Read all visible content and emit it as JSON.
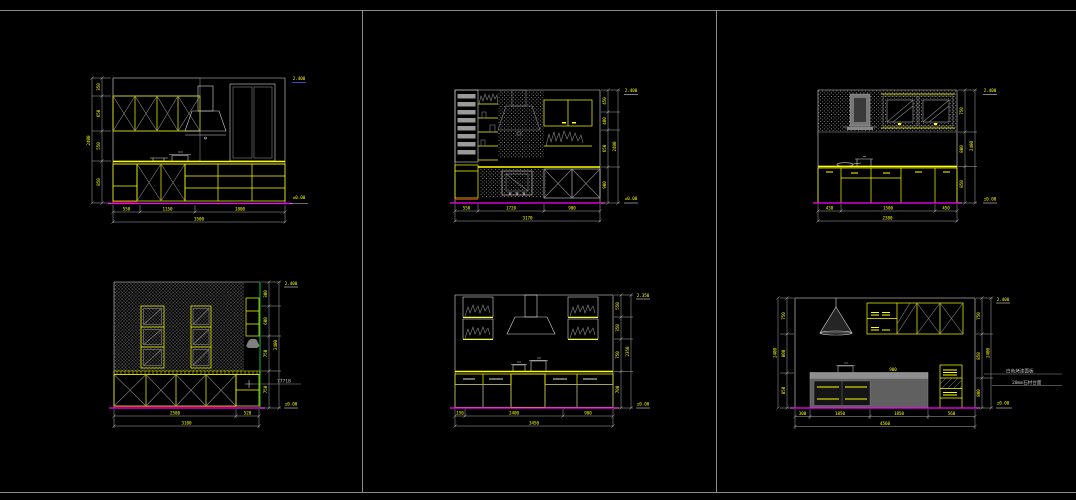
{
  "canvas": {
    "background": "#000000",
    "frame_color": "#8c8c8c"
  },
  "colors": {
    "cabinet_outline": "#ffff00",
    "floor_line": "#ff00ff",
    "dimension_text": "#ffff00",
    "dimension_line": "#c0c0c0",
    "hatch": "#8f8f8f",
    "accent_green": "#00dd44",
    "accent_red": "#ff2a2a"
  },
  "d1": {
    "dims_left": [
      "350",
      "650",
      "550",
      "850"
    ],
    "total_left": "2400",
    "dims_bottom": [
      "550",
      "1150",
      "1800"
    ],
    "total_bottom": "3500",
    "level_top": "2.400",
    "level_bottom": "±0.00"
  },
  "d2": {
    "dims_right": [
      "450",
      "400",
      "650",
      "900"
    ],
    "total_right": "2400",
    "dims_bottom": [
      "550",
      "1720",
      "900"
    ],
    "total_bottom": "3170",
    "level_top": "2.400",
    "level_bottom": "±0.00"
  },
  "d3": {
    "dims_right": [
      "750",
      "800",
      "850"
    ],
    "total_right": "2400",
    "dims_bottom": [
      "430",
      "1500",
      "450"
    ],
    "total_bottom": "2380",
    "level_top": "2.400",
    "level_bottom": "±0.00"
  },
  "d4": {
    "dims_right": [
      "300",
      "600",
      "750",
      "750"
    ],
    "total_right": "2400",
    "dims_bottom": [
      "2580",
      "520"
    ],
    "total_bottom": "3100",
    "level_top": "2.400",
    "level_bottom": "±0.00",
    "note": "7771B"
  },
  "d5": {
    "dims_right": [
      "550",
      "350",
      "750",
      "700"
    ],
    "total_right": "2350",
    "dims_bottom": [
      "150",
      "2400",
      "900"
    ],
    "total_bottom": "3450",
    "level_top": "2.350",
    "level_bottom": "±0.00"
  },
  "d6": {
    "dims_left": [
      "750",
      "800",
      "850"
    ],
    "total_left": "2400",
    "dims_right": [
      "750",
      "850",
      "800"
    ],
    "total_right": "2400",
    "dims_bottom": [
      "300",
      "1850",
      "1850",
      "560"
    ],
    "total_bottom": "4560",
    "level_top": "2.400",
    "level_bottom": "±0.00",
    "island_label": "900",
    "note1": "白色烤漆面板",
    "note2": "20mm石材台面"
  }
}
